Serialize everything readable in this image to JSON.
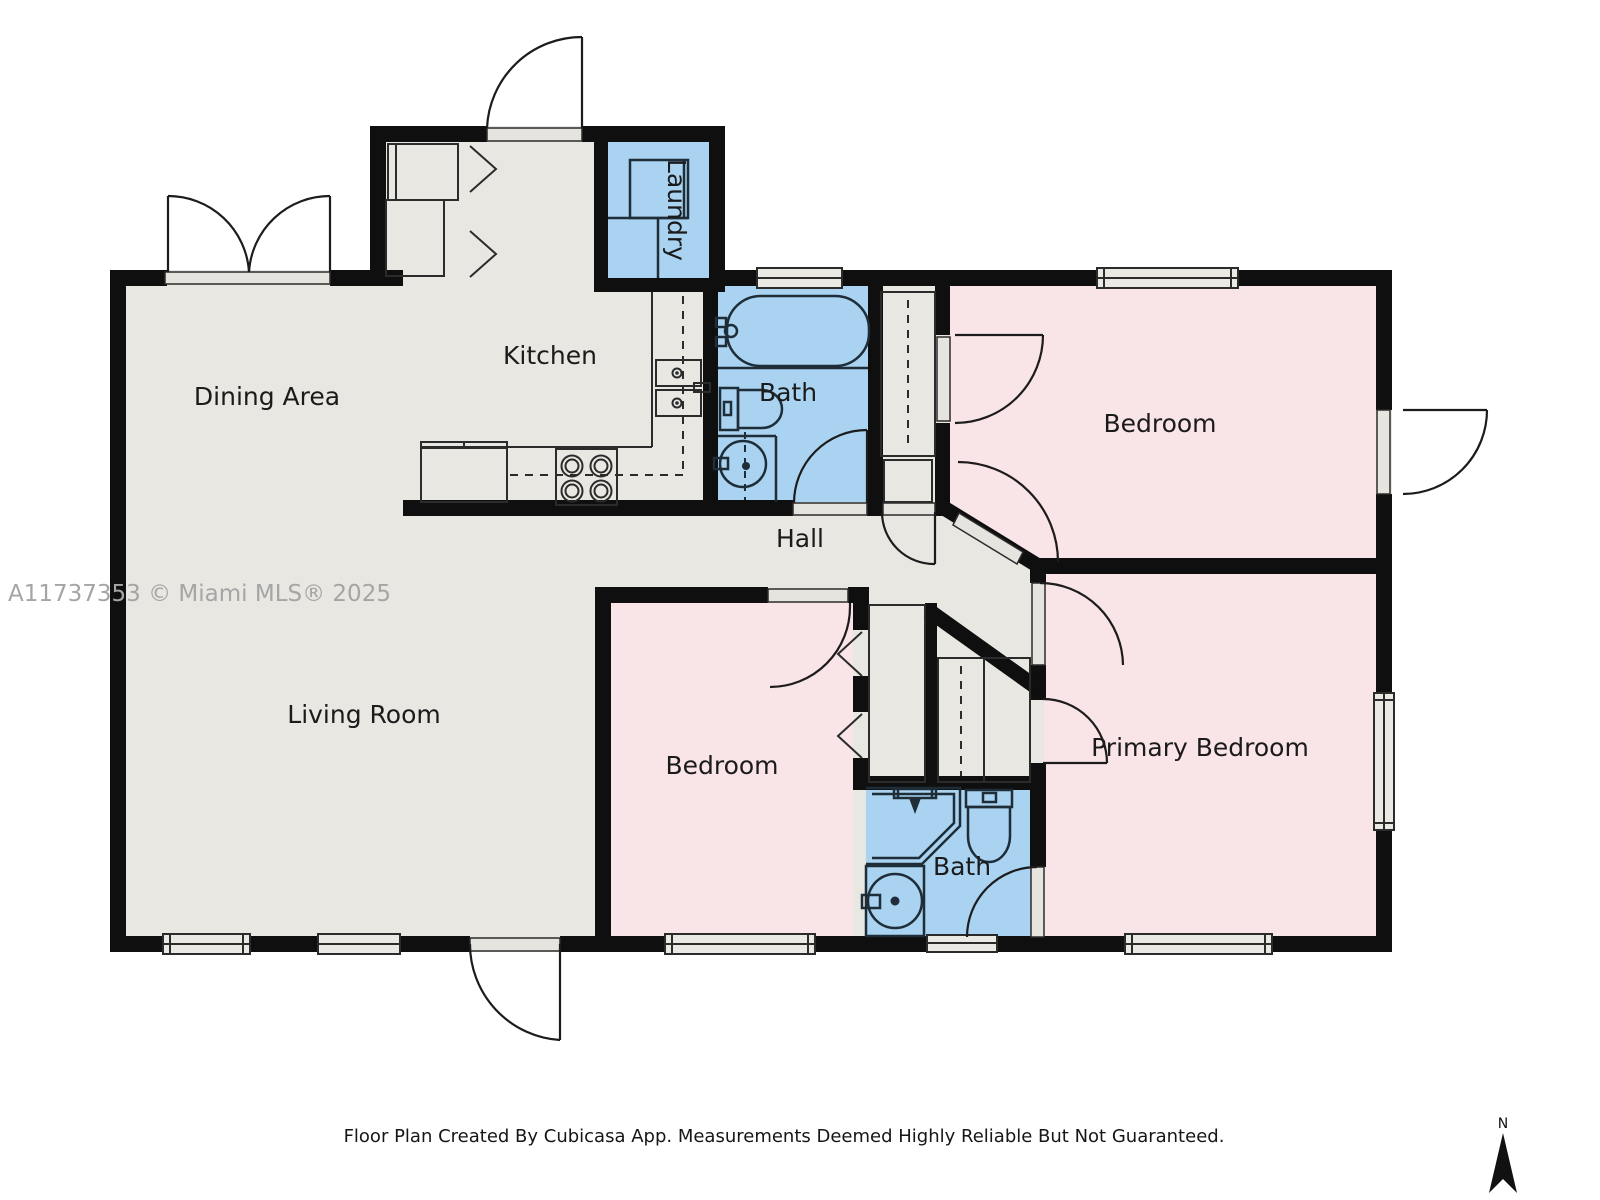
{
  "watermark": "A11737353 © Miami MLS® 2025",
  "footer": "Floor Plan Created By Cubicasa App. Measurements Deemed Highly Reliable But Not Guaranteed.",
  "compass": {
    "label": "N"
  },
  "rooms": [
    {
      "id": "dining-area",
      "label": "Dining Area"
    },
    {
      "id": "kitchen",
      "label": "Kitchen"
    },
    {
      "id": "laundry",
      "label": "Laundry"
    },
    {
      "id": "bath-top",
      "label": "Bath"
    },
    {
      "id": "hall",
      "label": "Hall"
    },
    {
      "id": "bedroom-top",
      "label": "Bedroom"
    },
    {
      "id": "living-room",
      "label": "Living Room"
    },
    {
      "id": "bedroom-bottom",
      "label": "Bedroom"
    },
    {
      "id": "bath-bottom",
      "label": "Bath"
    },
    {
      "id": "primary-bedroom",
      "label": "Primary Bedroom"
    }
  ],
  "colors": {
    "wall": "#0f0f0f",
    "floor": "#e9e7e2",
    "room_pink": "#f9e4e7",
    "wet_blue": "#a9d3f0",
    "window_fill": "#ebe9e4",
    "threshold_fill": "#e6e4de",
    "line": "#2b2b2b",
    "fixture": "#1e2d38",
    "label": "#1b1b1b",
    "watermark": "#a5a5a5"
  }
}
